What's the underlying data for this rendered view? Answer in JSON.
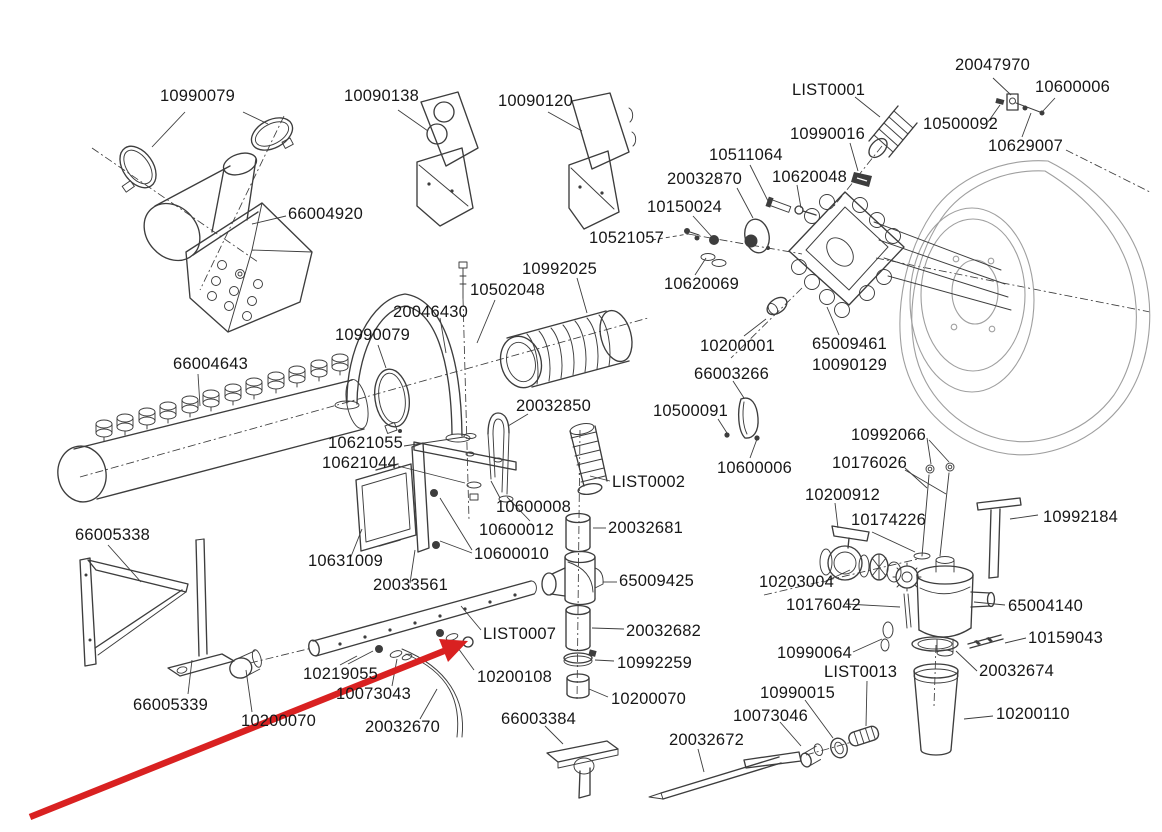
{
  "diagram": {
    "type": "exploded-parts-diagram",
    "colors": {
      "background": "#ffffff",
      "line": "#3d3d3d",
      "line_light": "#9f9f9f",
      "text": "#171717",
      "arrow_red": "#d92121"
    },
    "red_arrow": {
      "tail": {
        "x": 30,
        "y": 817
      },
      "tip": {
        "x": 468,
        "y": 641
      },
      "shaft_end": {
        "x": 444,
        "y": 651
      },
      "head_points": "468,641 439,639 448,662"
    },
    "part_labels": [
      {
        "text": "10990079",
        "x": 160,
        "y": 88
      },
      {
        "text": "10090138",
        "x": 344,
        "y": 88
      },
      {
        "text": "10090120",
        "x": 498,
        "y": 93
      },
      {
        "text": "66004920",
        "x": 288,
        "y": 206
      },
      {
        "text": "LIST0001",
        "x": 792,
        "y": 82
      },
      {
        "text": "20047970",
        "x": 955,
        "y": 57
      },
      {
        "text": "10600006",
        "x": 1035,
        "y": 79
      },
      {
        "text": "10500092",
        "x": 923,
        "y": 116
      },
      {
        "text": "10629007",
        "x": 988,
        "y": 138
      },
      {
        "text": "10990016",
        "x": 790,
        "y": 126
      },
      {
        "text": "10620048",
        "x": 772,
        "y": 169
      },
      {
        "text": "10511064",
        "x": 709,
        "y": 147
      },
      {
        "text": "20032870",
        "x": 667,
        "y": 171
      },
      {
        "text": "10150024",
        "x": 647,
        "y": 199
      },
      {
        "text": "10521057",
        "x": 589,
        "y": 230
      },
      {
        "text": "10620069",
        "x": 664,
        "y": 276
      },
      {
        "text": "10992025",
        "x": 522,
        "y": 261
      },
      {
        "text": "10502048",
        "x": 470,
        "y": 282
      },
      {
        "text": "20046430",
        "x": 393,
        "y": 304
      },
      {
        "text": "10990079",
        "x": 335,
        "y": 327
      },
      {
        "text": "66004643",
        "x": 173,
        "y": 356
      },
      {
        "text": "10200001",
        "x": 700,
        "y": 338
      },
      {
        "text": "65009461",
        "x": 812,
        "y": 336
      },
      {
        "text": "10090129",
        "x": 812,
        "y": 357
      },
      {
        "text": "66003266",
        "x": 694,
        "y": 366
      },
      {
        "text": "10500091",
        "x": 653,
        "y": 403
      },
      {
        "text": "10600006",
        "x": 717,
        "y": 460
      },
      {
        "text": "20032850",
        "x": 516,
        "y": 398
      },
      {
        "text": "10621055",
        "x": 328,
        "y": 435
      },
      {
        "text": "10621044",
        "x": 322,
        "y": 455
      },
      {
        "text": "LIST0002",
        "x": 612,
        "y": 474
      },
      {
        "text": "10600008",
        "x": 496,
        "y": 499
      },
      {
        "text": "10600012",
        "x": 479,
        "y": 522
      },
      {
        "text": "10600010",
        "x": 474,
        "y": 546
      },
      {
        "text": "10631009",
        "x": 308,
        "y": 553
      },
      {
        "text": "20033561",
        "x": 373,
        "y": 577
      },
      {
        "text": "20032681",
        "x": 608,
        "y": 520
      },
      {
        "text": "65009425",
        "x": 619,
        "y": 573
      },
      {
        "text": "20032682",
        "x": 626,
        "y": 623
      },
      {
        "text": "10992259",
        "x": 617,
        "y": 655
      },
      {
        "text": "10200070",
        "x": 611,
        "y": 691
      },
      {
        "text": "10992066",
        "x": 851,
        "y": 427
      },
      {
        "text": "10176026",
        "x": 832,
        "y": 455
      },
      {
        "text": "10200912",
        "x": 805,
        "y": 487
      },
      {
        "text": "10174226",
        "x": 851,
        "y": 512
      },
      {
        "text": "10992184",
        "x": 1043,
        "y": 509
      },
      {
        "text": "10203004",
        "x": 759,
        "y": 574
      },
      {
        "text": "10176042",
        "x": 786,
        "y": 597
      },
      {
        "text": "65004140",
        "x": 1008,
        "y": 598
      },
      {
        "text": "10159043",
        "x": 1028,
        "y": 630
      },
      {
        "text": "66005338",
        "x": 75,
        "y": 527
      },
      {
        "text": "66005339",
        "x": 133,
        "y": 697
      },
      {
        "text": "10219055",
        "x": 303,
        "y": 666
      },
      {
        "text": "10073043",
        "x": 336,
        "y": 686
      },
      {
        "text": "10200070",
        "x": 241,
        "y": 713
      },
      {
        "text": "20032670",
        "x": 365,
        "y": 719
      },
      {
        "text": "LIST0007",
        "x": 483,
        "y": 626
      },
      {
        "text": "10200108",
        "x": 477,
        "y": 669
      },
      {
        "text": "66003384",
        "x": 501,
        "y": 711
      },
      {
        "text": "10990064",
        "x": 777,
        "y": 645
      },
      {
        "text": "LIST0013",
        "x": 824,
        "y": 664
      },
      {
        "text": "20032674",
        "x": 979,
        "y": 663
      },
      {
        "text": "10990015",
        "x": 760,
        "y": 685
      },
      {
        "text": "10073046",
        "x": 733,
        "y": 708
      },
      {
        "text": "20032672",
        "x": 669,
        "y": 732
      },
      {
        "text": "10200110",
        "x": 996,
        "y": 706
      }
    ]
  }
}
